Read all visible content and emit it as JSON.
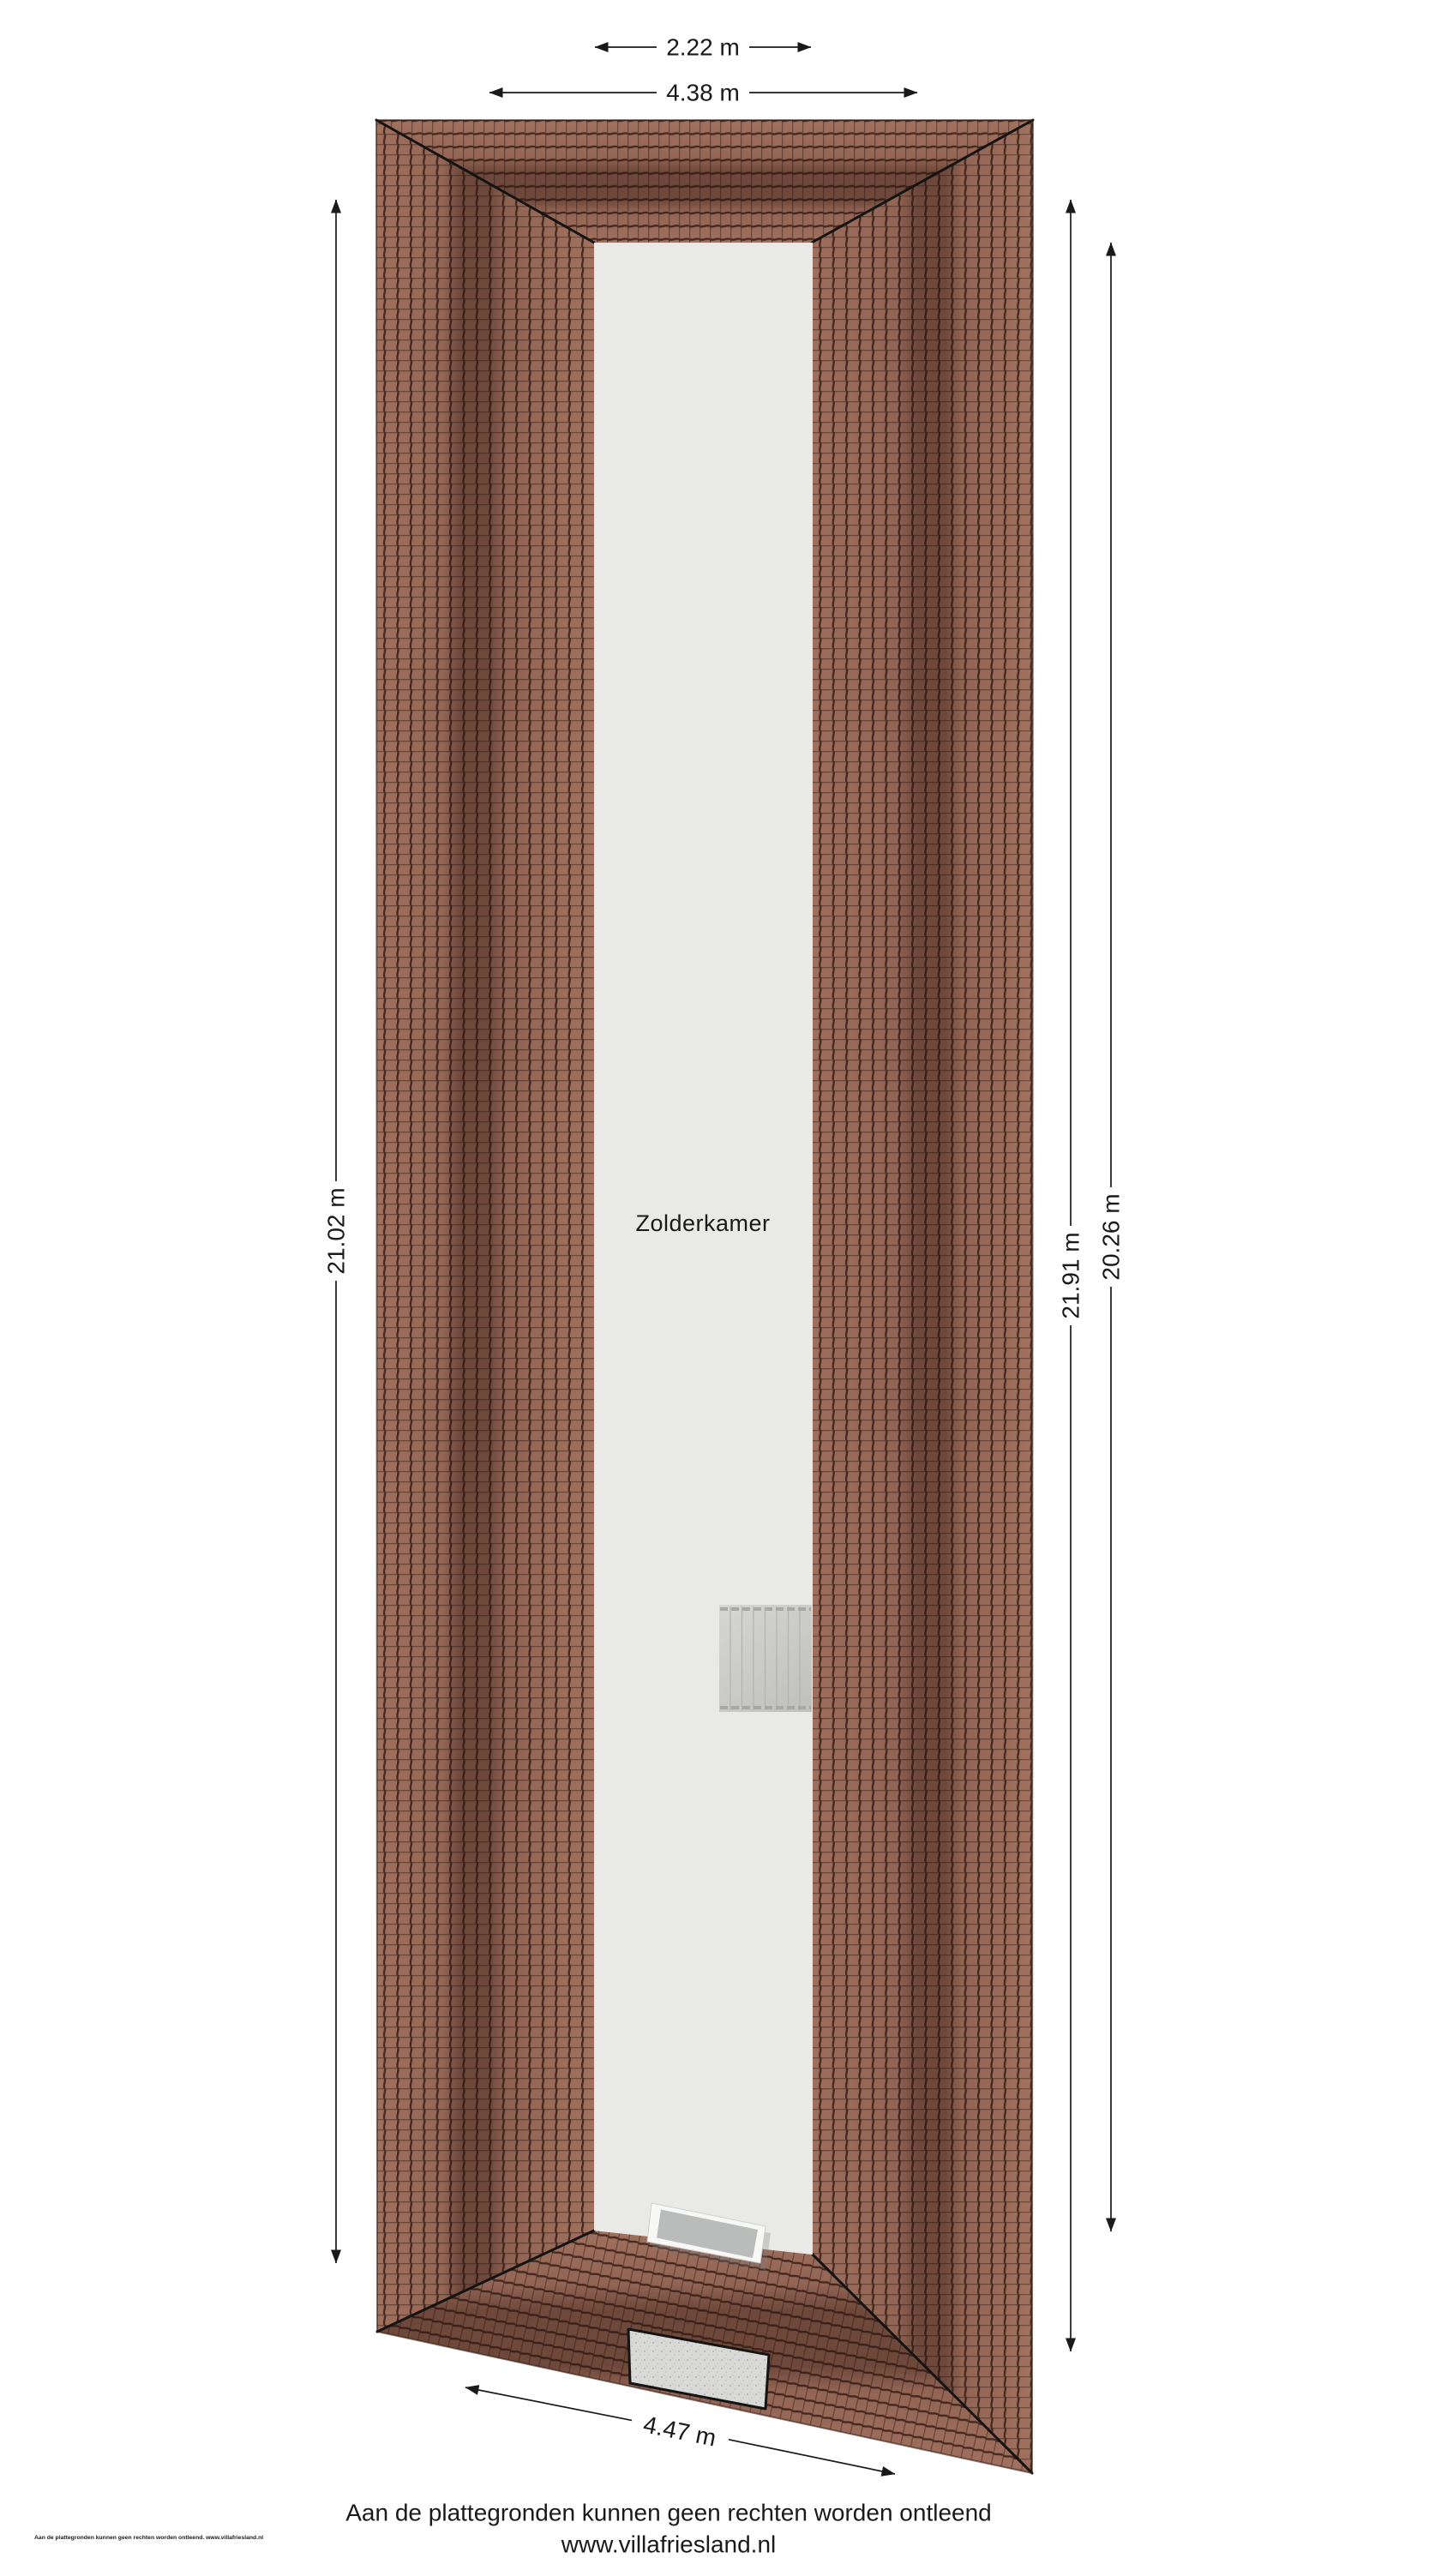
{
  "plan": {
    "room": {
      "label": "Zolderkamer"
    },
    "dimensions": {
      "top_inner": "2.22 m",
      "top_outer": "4.38 m",
      "left": "21.02 m",
      "right_outer": "21.91 m",
      "right_inner": "20.26 m",
      "bottom": "4.47 m"
    },
    "footer": {
      "disclaimer": "Aan de plattegronden kunnen geen rechten worden ontleend",
      "website": "www.villafriesland.nl",
      "fineprint": "Aan de plattegronden kunnen geen rechten worden ontleend. www.villafriesland.nl"
    },
    "colors": {
      "tile_base": "#a87663",
      "tile_joint": "#3f241c",
      "ridge_shadow": "#2a130c",
      "room_fill": "#e9e9e8",
      "stairs_fill": "#cbcbca",
      "chimney_fill": "#d9d9d7",
      "glass_fill": "#b9bcba",
      "annotation": "#1a1a1a"
    }
  }
}
